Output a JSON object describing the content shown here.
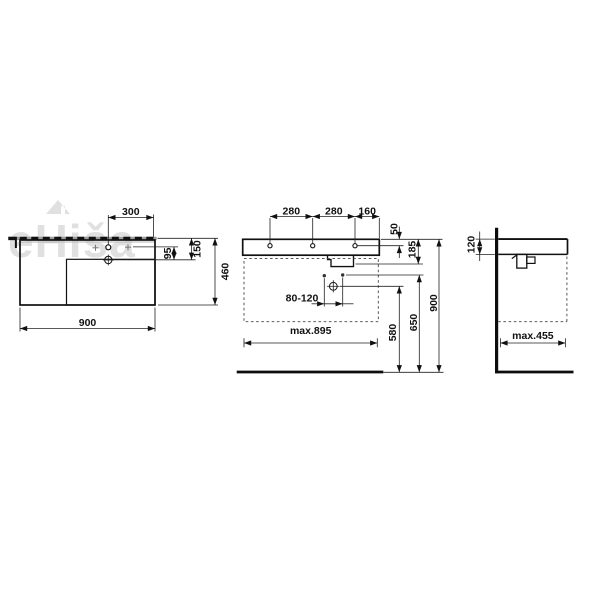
{
  "watermark": {
    "text": "eHiša"
  },
  "plan_view": {
    "tap_hole_offset": "300",
    "tap_to_drain": "95",
    "rear_to_drain": "150",
    "depth": "460",
    "width": "900"
  },
  "front_view": {
    "hole_spacing_left": "280",
    "hole_spacing_right": "280",
    "hole_edge_offset": "160",
    "rim_to_holes": "50",
    "body_height": "185",
    "drain_offset_range": "80-120",
    "drain_height": "580",
    "fixing_height": "650",
    "rim_height": "900",
    "max_width": "max.895"
  },
  "side_view": {
    "front_edge_height": "120",
    "max_depth": "max.455"
  }
}
